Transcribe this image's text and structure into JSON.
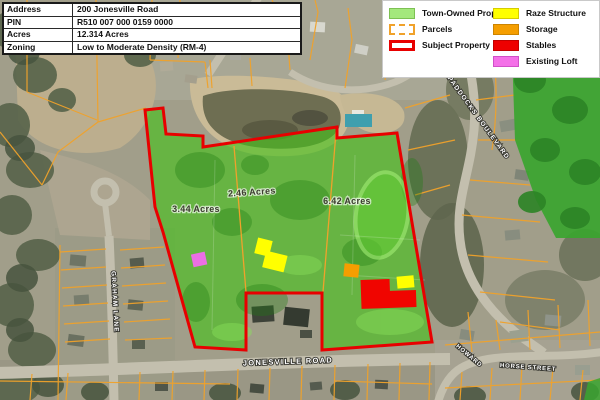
{
  "info_table": {
    "rows": [
      {
        "label": "Address",
        "value": "200 Jonesville Road"
      },
      {
        "label": "PIN",
        "value": "R510 007 000 0159 0000"
      },
      {
        "label": "Acres",
        "value": "12.314 Acres"
      },
      {
        "label": "Zoning",
        "value": "Low to Moderate Density (RM-4)"
      }
    ]
  },
  "legend": {
    "column1": [
      {
        "label": "Town-Owned Property"
      },
      {
        "label": "Parcels"
      },
      {
        "label": "Subject Property"
      }
    ],
    "column2": [
      {
        "label": "Raze Structure"
      },
      {
        "label": "Storage"
      },
      {
        "label": "Stables"
      },
      {
        "label": "Existing Loft"
      }
    ]
  },
  "map": {
    "acreage_labels": [
      {
        "text": "3.44 Acres"
      },
      {
        "text": "2.46 Acres"
      },
      {
        "text": "6.42 Acres"
      }
    ],
    "street_labels": {
      "jonesville": "JONESVILLE ROAD",
      "graham": "GRAHAM LANE",
      "paddocks": "PADDOCKS BOULEVARD",
      "hackney": "HACKNEY",
      "horse_street_1": "HOWARD",
      "horse_street_2": "HORSE STREET"
    },
    "colors": {
      "town_owned_green": "#a4e87c",
      "subject_red": "#e80000",
      "parcel_orange": "#f0a22b",
      "raze_yellow": "#ffff00",
      "storage_orange": "#f59e00",
      "stables_red": "#ee0000",
      "loft_pink": "#f470e8"
    }
  }
}
